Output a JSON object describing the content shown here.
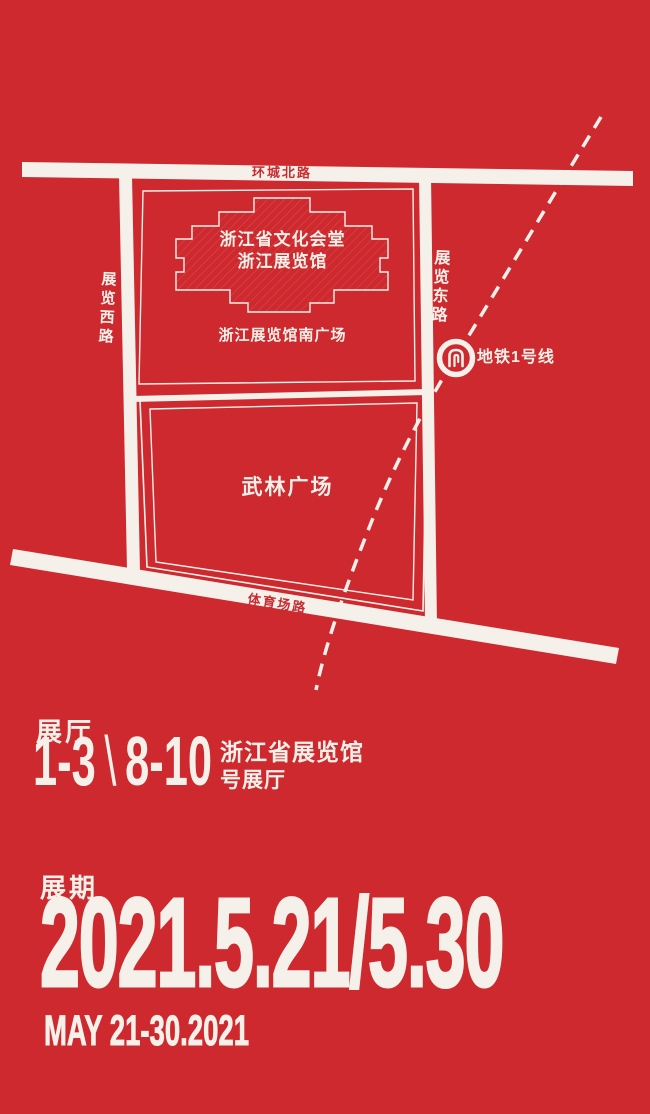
{
  "theme": {
    "background": "#CE292E",
    "foreground": "#F5F1EA",
    "road_text_red": "#C92A2F"
  },
  "map": {
    "road_north": "环城北路",
    "road_west": "展览西路",
    "road_east": "展览东路",
    "road_south": "体育场路",
    "hall_line1": "浙江省文化会堂",
    "hall_line2": "浙江展览馆",
    "south_square": "浙江展览馆南广场",
    "wulin_square": "武林广场",
    "metro_label": "地铁1号线"
  },
  "info": {
    "halls": {
      "title": "展厅",
      "range_a": "1-3",
      "separator": "\\",
      "range_b": "8-10",
      "venue": "浙江省展览馆",
      "venue_suffix": "号展厅"
    },
    "period": {
      "title": "展期",
      "date_numeric": "2021.5.21/5.30",
      "date_english": "MAY 21-30.2021"
    }
  }
}
